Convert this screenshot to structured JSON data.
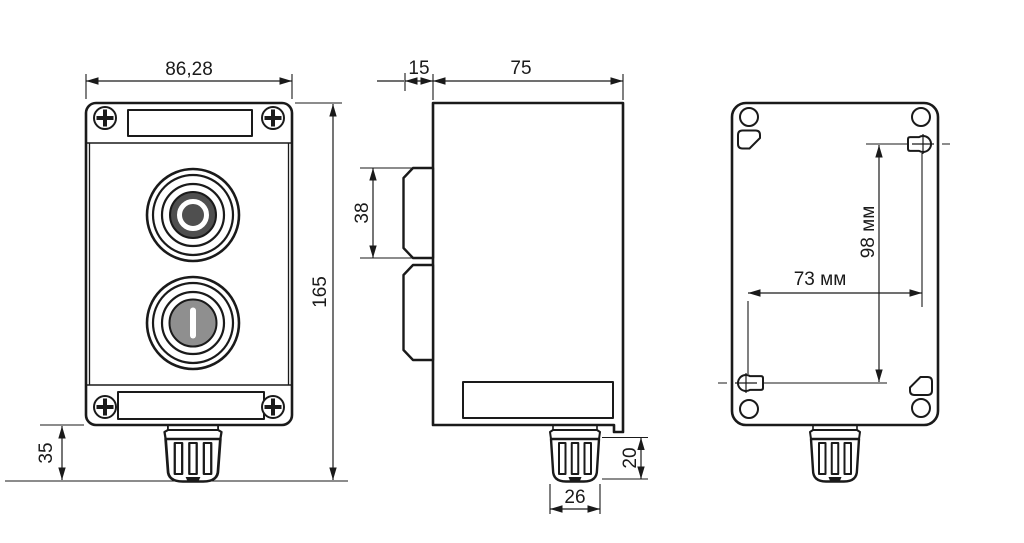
{
  "drawing": {
    "type": "technical_drawing",
    "subject": "two-button push-button control station, three orthographic views"
  },
  "dimensions": {
    "front_width": "86,28",
    "front_height": "165",
    "gland_protrusion": "35",
    "lid_depth": "15",
    "body_depth": "75",
    "button_block_height": "38",
    "gland_height": "20",
    "gland_width": "26",
    "mount_hole_spacing_h": "73 мм",
    "mount_hole_spacing_v": "98 мм"
  },
  "buttons": {
    "stop_symbol": "O",
    "start_symbol": "I"
  },
  "colors": {
    "line": "#1a1a1a",
    "stop_button_fill": "#4f4f4f",
    "start_button_fill": "#8f8f8f",
    "symbol": "#ffffff",
    "background": "#ffffff"
  }
}
